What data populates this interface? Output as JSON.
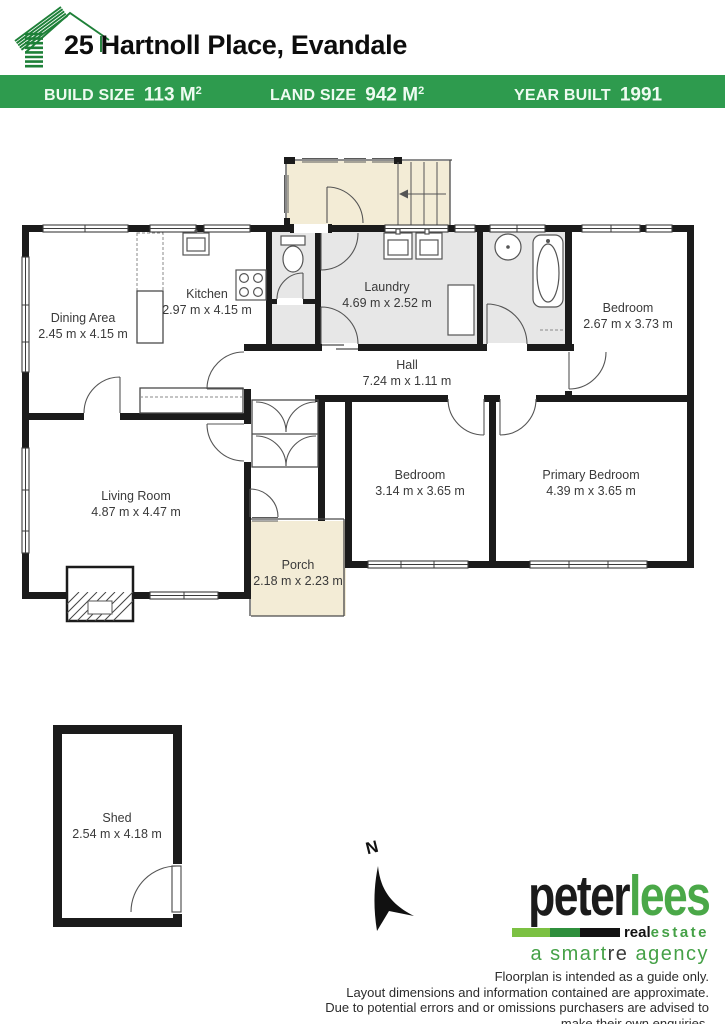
{
  "header": {
    "address": "25 Hartnoll Place, Evandale",
    "stats": [
      {
        "label": "BUILD SIZE",
        "value": "113 M",
        "sup": "2"
      },
      {
        "label": "LAND SIZE",
        "value": "942 M",
        "sup": "2"
      },
      {
        "label": "YEAR BUILT",
        "value": "1991",
        "sup": ""
      }
    ]
  },
  "floorplan": {
    "north_label": "N",
    "rooms": [
      {
        "name": "Dining Area",
        "dims": "2.45 m x 4.15 m"
      },
      {
        "name": "Kitchen",
        "dims": "2.97 m x 4.15 m"
      },
      {
        "name": "Laundry",
        "dims": "4.69 m x 2.52 m"
      },
      {
        "name": "Bedroom",
        "dims": "2.67 m x 3.73 m"
      },
      {
        "name": "Hall",
        "dims": "7.24 m x 1.11 m"
      },
      {
        "name": "Living Room",
        "dims": "4.87 m x 4.47 m"
      },
      {
        "name": "Bedroom",
        "dims": "3.14 m x 3.65 m"
      },
      {
        "name": "Primary Bedroom",
        "dims": "4.39 m x 3.65 m"
      },
      {
        "name": "Porch",
        "dims": "2.18 m x 2.23 m"
      },
      {
        "name": "Shed",
        "dims": "2.54 m x 4.18 m"
      }
    ],
    "colors": {
      "wall": "#1b1b1b",
      "wet_area": "#e7e7e7",
      "outdoor_area": "#f3ecd6"
    }
  },
  "footer": {
    "logo": {
      "word_black": "peter",
      "word_green": "lees",
      "sub_black": "real",
      "sub_green": "estate",
      "tag_green_1": "a smart",
      "tag_dark": "re",
      "tag_green_2": " agency"
    },
    "disclaimer_lines": [
      "Floorplan is intended as a guide only.",
      "Layout dimensions and information contained are approximate.",
      "Due to potential errors and or omissions purchasers are advised to",
      "make their own enquiries."
    ]
  },
  "brand_colors": {
    "banner_green": "#2e9b4e",
    "logo_green": "#4aa848",
    "bar_light_green": "#7cc143",
    "bar_dark_green": "#2f8f3c"
  }
}
